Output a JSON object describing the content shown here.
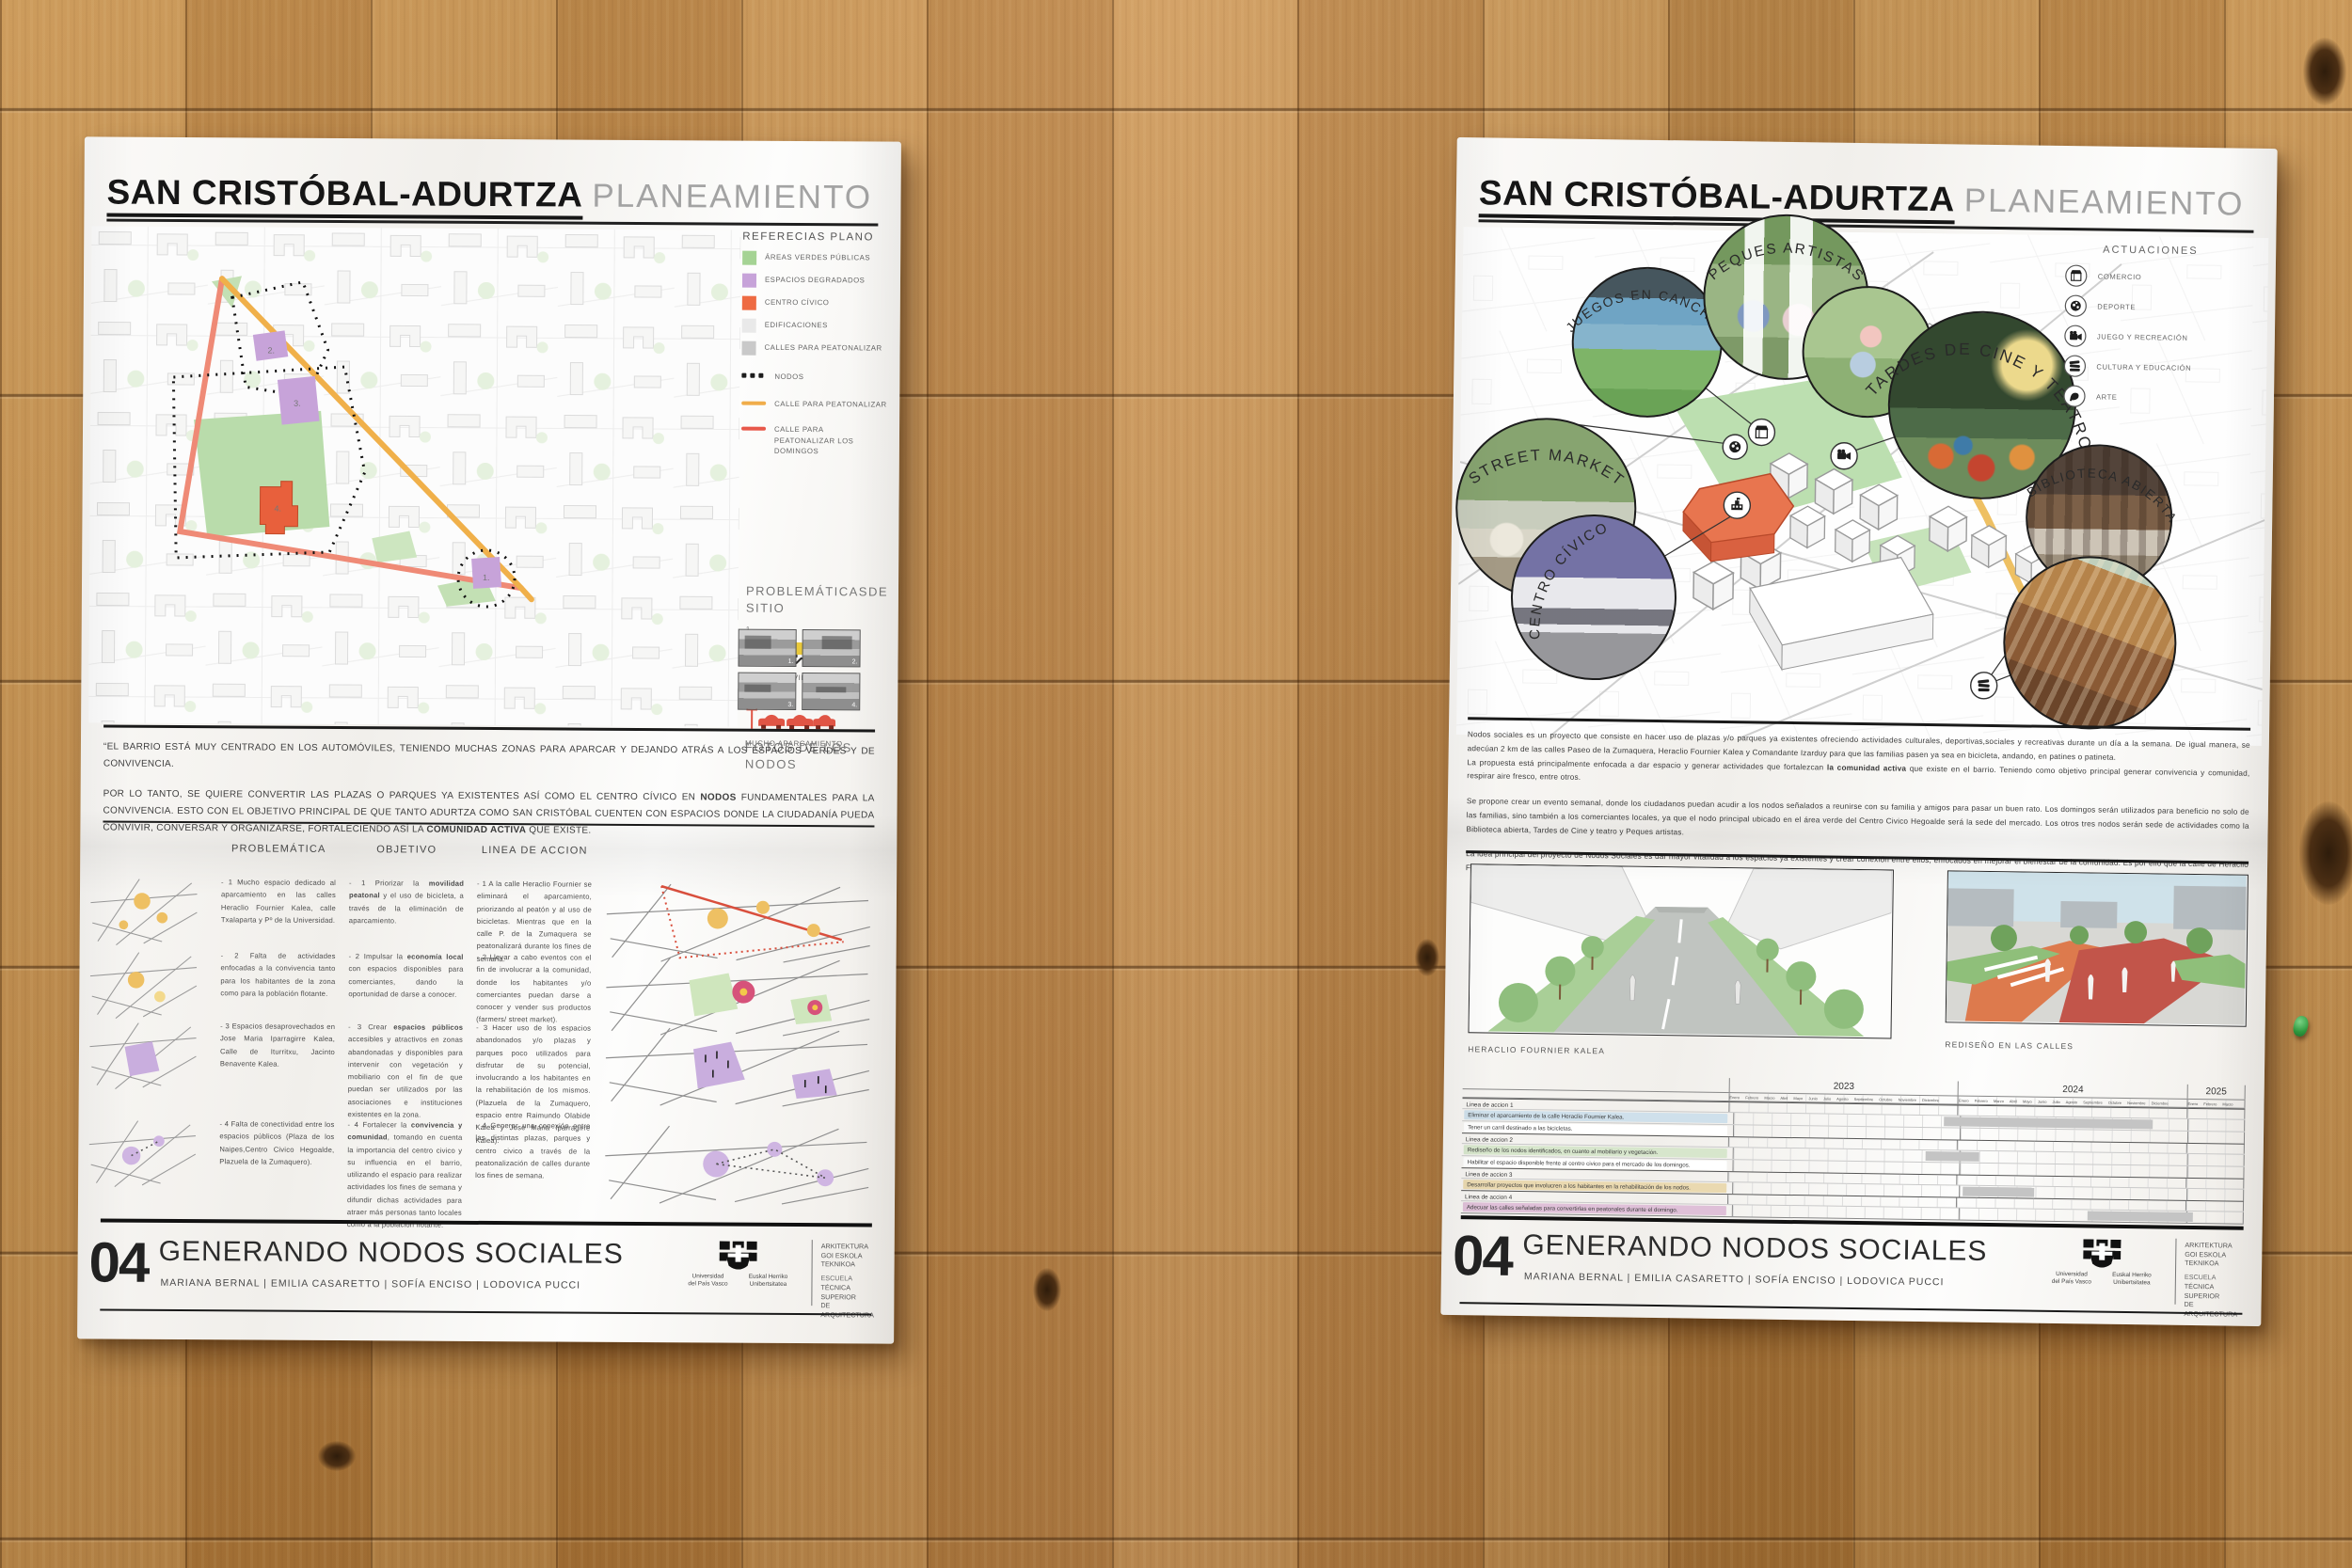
{
  "title": {
    "bold": "SAN CRISTÓBAL-ADURTZA",
    "light": "PLANEAMIENTO ESTRATÉGICO URBANO"
  },
  "footer": {
    "number": "04",
    "title": "GENERANDO NODOS SOCIALES",
    "authors": "MARIANA BERNAL   |   EMILIA CASARETTO   |   SOFÍA ENCISO   |   LODOVICA PUCCI",
    "logo": [
      "Universidad",
      "del País Vasco",
      "Euskal Herriko",
      "Unibertsitatea"
    ],
    "school": [
      "ARKITEKTURA",
      "GOI ESKOLA",
      "TEKNIKOA",
      "ESCUELA",
      "TÉCNICA SUPERIOR",
      "DE ARQUITECTURA"
    ]
  },
  "left": {
    "legend": {
      "title": "REFERECIAS PLANO",
      "items": [
        {
          "label": "ÁREAS VERDES PÚBLICAS",
          "color": "#a5d394"
        },
        {
          "label": "ESPACIOS DEGRADADOS",
          "color": "#c7a3d9"
        },
        {
          "label": "CENTRO CÍVICO",
          "color": "#ee6b43"
        },
        {
          "label": "EDIFICACIONES",
          "color": "#e9e9e9"
        },
        {
          "label": "CALLES PARA PEATONALIZAR",
          "color": "#c9c9c9"
        },
        {
          "label": "NODOS"
        },
        {
          "label": "CALLE PARA PEATONALIZAR",
          "color": "#f0ad4a"
        },
        {
          "label": "CALLE PARA PEATONALIZAR LOS DOMINGOS",
          "color": "#e8584a"
        }
      ]
    },
    "problematicas": {
      "title": "PROBLEMÁTICASDE SITIO",
      "items": [
        {
          "num": "1.",
          "label": "EL AUTOMÓVIL DOMINA"
        },
        {
          "num": "2.",
          "label": "MUCHO APARCAMIENTO"
        }
      ]
    },
    "fotos": {
      "title": "FOTOS DE LOS NODOS",
      "numbers": [
        "1.",
        "2.",
        "3.",
        "4."
      ]
    },
    "map_numbers": [
      "1.",
      "2.",
      "3.",
      "4."
    ],
    "intro": {
      "p1": "“EL BARRIO ESTÁ MUY CENTRADO EN LOS AUTOMÓVILES, TENIENDO MUCHAS ZONAS PARA APARCAR Y DEJANDO ATRÁS A LOS ESPACIOS VERDES Y DE CONVIVENCIA.",
      "p2": [
        "POR LO TANTO, SE QUIERE CONVERTIR LAS PLAZAS O PARQUES YA EXISTENTES ASÍ COMO EL CENTRO CÍVICO EN ",
        "NODOS",
        " FUNDAMENTALES PARA LA CONVIVENCIA. ESTO CON EL OBJETIVO PRINCIPAL DE QUE TANTO ADURTZA COMO SAN CRISTÓBAL CUENTEN CON ESPACIOS DONDE LA CIUDADANÍA PUEDA CONVIVIR, CONVERSAR Y ORGANIZARSE, FORTALECIENDO ASÍ LA ",
        "COMUNIDAD ACTIVA",
        " QUE EXISTE."
      ]
    },
    "table": {
      "headers": [
        "PROBLEMÁTICA",
        "OBJETIVO",
        "LINEA DE ACCION"
      ],
      "rows": [
        {
          "problematica": "- 1 Mucho espacio dedicado al aparcamiento en las calles Heraclio Fournier Kalea, calle Txalaparta y Pº de la Universidad.",
          "objetivo": [
            "- 1 Priorizar la ",
            "movilidad peatonal",
            " y el uso de bicicleta, a través de la eliminación de aparcamiento."
          ],
          "linea": "- 1 A la calle Heraclio Fournier se eliminará el aparcamiento, priorizando al peatón y al uso de bicicletas. Mientras que en la calle P. de la Zumaquera se peatonalizará durante los fines de semana."
        },
        {
          "problematica": "- 2 Falta de actividades enfocadas a la convivencia tanto para los habitantes de la zona como para la población flotante.",
          "objetivo": [
            "- 2 Impulsar la ",
            "economía local",
            " con espacios disponibles para comerciantes, dando la oportunidad de darse a conocer."
          ],
          "linea": "- 2 Llevar a cabo eventos con el fin de involucrar a la comunidad, donde los habitantes y/o comerciantes puedan darse a conocer y vender sus productos (farmers/ street market)."
        },
        {
          "problematica": "- 3 Espacios desaprovechados en Jose Maria Iparragirre Kalea, Calle de Iturritxu, Jacinto Benavente Kalea.",
          "objetivo": [
            "- 3 Crear ",
            "espacios públicos",
            " accesibles y atractivos en zonas abandonadas y disponibles para intervenir con vegetación y mobiliario con el fin de que puedan ser utilizados por las asociaciones e instituciones existentes en la zona."
          ],
          "linea": "- 3 Hacer uso de los espacios abandonados y/o plazas y parques poco utilizados para disfrutar de su potencial, involucrando a los habitantes en la rehabilitación de los mismos. (Plazuela de la Zumaquero, espacio entre Raimundo Olabide Kalea y José Maria Iparragirre Kalea)."
        },
        {
          "problematica": "- 4 Falta de conectividad entre los espacios públicos (Plaza de los Naipes,Centro Civico Hegoalde, Plazuela de la Zumaquero).",
          "objetivo": [
            "- 4 Fortalecer la ",
            "convivencia y comunidad",
            ", tomando en cuenta la importancia del centro civico y su influencia en el barrio, utilizando el espacio para realizar actividades los fines de semana y difundir dichas actividades para atraer más personas tanto locales como a la población flotante."
          ],
          "linea": "- 4 Generar una conexión entre las distintas plazas, parques y centro civico a través de la peatonalización de calles durante los fines de semana."
        }
      ]
    }
  },
  "right": {
    "nodes": {
      "labels": [
        "STREET MARKET",
        "JUEGOS EN CANCHAS",
        "PEQUES ARTISTAS",
        "TARDES DE CINE Y TEATRO",
        "BIBLIOTECA ABIERTA",
        "CENTRO CÍVICO"
      ]
    },
    "actuaciones": {
      "title": "ACTUACIONES",
      "items": [
        {
          "icon": "storefront-icon",
          "label": "COMERCIO"
        },
        {
          "icon": "soccer-ball-icon",
          "label": "DEPORTE"
        },
        {
          "icon": "movie-camera-icon",
          "label": "JUEGO Y RECREACIÓN"
        },
        {
          "icon": "books-icon",
          "label": "CULTURA Y EDUCACIÓN"
        },
        {
          "icon": "art-icon",
          "label": "ARTE"
        }
      ]
    },
    "paragraphs": {
      "p1a": "Nodos sociales es un proyecto que consiste en hacer uso de plazas y/o parques ya existentes ofreciendo actividades culturales, deportivas,sociales y recreativas durante un día a la semana. De igual manera, se adecúan 2 km de las calles Paseo de la Zumaquera, Heraclio Fournier Kalea y Comandante Izarduy para que las familias pasen ya sea en bicicleta, andando, en patines o patineta.",
      "p1b": [
        "La propuesta está principalmente enfocada a dar espacio y generar actividades que fortalezcan ",
        "la comunidad activa",
        " que existe en el barrio. Teniendo como objetivo principal generar convivencia y comunidad, respirar aire fresco, entre otros."
      ],
      "p2": "Se propone crear un evento semanal, donde los ciudadanos puedan acudir a los nodos señalados a reunirse con su familia y amigos para pasar un buen rato. Los domingos serán utilizados para beneficio no solo de las familias, sino también a los comerciantes locales, ya que el nodo principal ubicado en el área verde del Centro Civico Hegoalde será la sede del mercado. Los otros tres nodos serán sede de actividades como la Biblioteca abierta, Tardes de Cine y teatro y Peques artistas.",
      "p3": "La idea principal del proyecto de Nodos Sociales es dar mayor vitalidad a los espacios ya existentes y crear conexión entre ellos, enfocados en mejorar el bienestar de la comunidad. Es por ello que la calle de Heraclio Fournier se rediseñará, eliminando el aparcamiento y priorizando de esa manera al peatón."
    },
    "renders": [
      {
        "caption": "HERACLIO FOURNIER KALEA"
      },
      {
        "caption": "REDISEÑO EN LAS CALLES"
      }
    ],
    "timeline": {
      "years": [
        "2023",
        "2024",
        "2025"
      ],
      "months_full": "Enero Febrero Marzo Abril Mayo Junio Julio Agosto Septiembre Octubre Noviembre Diciembre",
      "months_q1": "Enero Febrero Marzo",
      "rows": [
        {
          "type": "section",
          "label": "Linea de accion 1"
        },
        {
          "type": "task",
          "label": "Eliminar el aparcamiento de la calle Heraclio Fournier Kalea.",
          "color": "#cfe0eb"
        },
        {
          "type": "task",
          "label": "Tener un carril destinado a las bicicletas.",
          "color": "#ffffff"
        },
        {
          "type": "section",
          "label": "Linea de accion 2"
        },
        {
          "type": "task",
          "label": "Rediseño de los nodos identificados, en cuanto al mobiliario y vegetación.",
          "color": "#d7e6cc"
        },
        {
          "type": "task",
          "label": "Habilitar el espacio disponible frente al centro civico para el mercado de los domingos.",
          "color": "#ffffff"
        },
        {
          "type": "section",
          "label": "Linea de accion 3"
        },
        {
          "type": "task",
          "label": "Desarrollar proyectos que involucren a los habitantes en la rehabilitación de los nodos.",
          "color": "#ead9b0"
        },
        {
          "type": "section",
          "label": "Linea de accion 4"
        },
        {
          "type": "task",
          "label": "Adecuar las calles señaladas para convertirlas en peatonales durante el domingo.",
          "color": "#dfc0d8"
        }
      ],
      "bars": [
        {
          "left": "41%",
          "width": "41%"
        },
        {
          "left": "37.5%",
          "width": "10.5%"
        },
        {
          "left": "45%",
          "width": "14%"
        },
        {
          "left": "69.5%",
          "width": "20.5%"
        }
      ]
    }
  }
}
